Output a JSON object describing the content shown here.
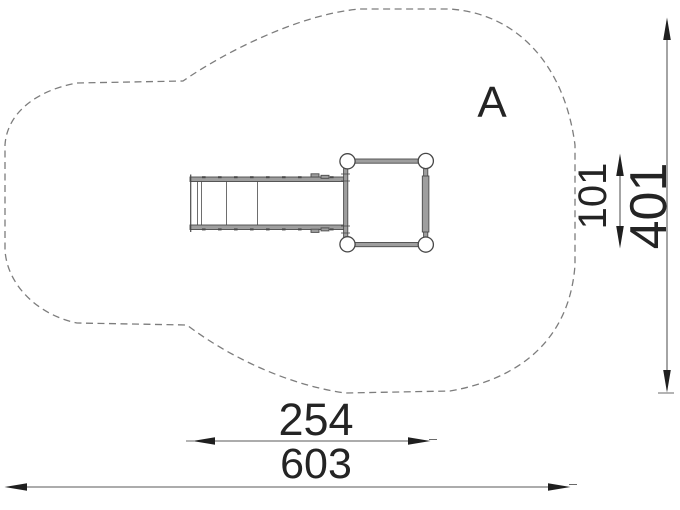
{
  "drawing": {
    "zone_label": "A",
    "dimensions": {
      "platform_depth": "101",
      "total_depth": "401",
      "equipment_width": "254",
      "total_width": "603"
    },
    "colors": {
      "background": "#ffffff",
      "safety_outline": "#7d7d7d",
      "equipment_line": "#4a4a4a",
      "equipment_fill": "#9e9e9e",
      "dimension_line": "#5a5a5a",
      "arrow": "#1f1f1f",
      "text": "#242424"
    }
  }
}
